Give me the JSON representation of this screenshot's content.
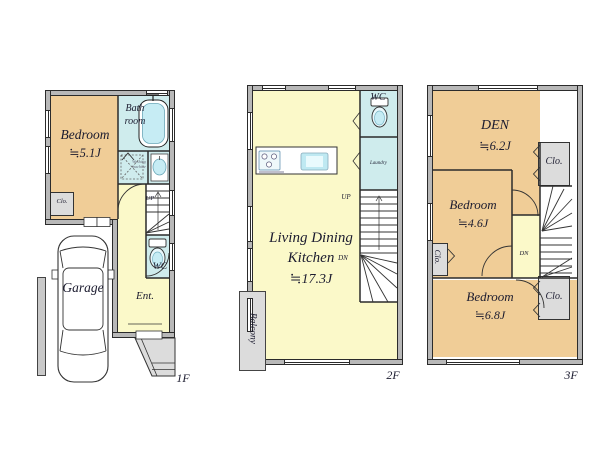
{
  "palette": {
    "room_tan": "#f0cd97",
    "room_aqua": "#cfeced",
    "room_cream": "#fbf9c9",
    "gray_fill": "#dcdcdc",
    "wall_gray": "#b8b8b8",
    "line": "#2b2b2b",
    "text": "#1b1b2f"
  },
  "floor1": {
    "floor_label": "1F",
    "bedroom_name": "Bedroom",
    "bedroom_area": "≒5.1J",
    "bath_line1": "Bath",
    "bath_line2": "room",
    "closet": "Clo.",
    "up": "UP",
    "wc": "WC",
    "entrance": "Ent.",
    "garage": "Garage",
    "washer_line1": "Washing",
    "washer_line2": "machine"
  },
  "floor2": {
    "floor_label": "2F",
    "ldk_line1": "Living Dining",
    "ldk_line2": "Kitchen",
    "ldk_area": "≒17.3J",
    "wc": "WC",
    "laundry": "Laundry",
    "up": "UP",
    "dn": "DN",
    "balcony": "Balcony"
  },
  "floor3": {
    "floor_label": "3F",
    "den_name": "DEN",
    "den_area": "≒6.2J",
    "closet_top": "Clo.",
    "bedroom1_name": "Bedroom",
    "bedroom1_area": "≒4.6J",
    "closet_left": "Clo.",
    "dn": "DN",
    "bedroom2_name": "Bedroom",
    "bedroom2_area": "≒6.8J",
    "closet_bottom": "Clo."
  }
}
